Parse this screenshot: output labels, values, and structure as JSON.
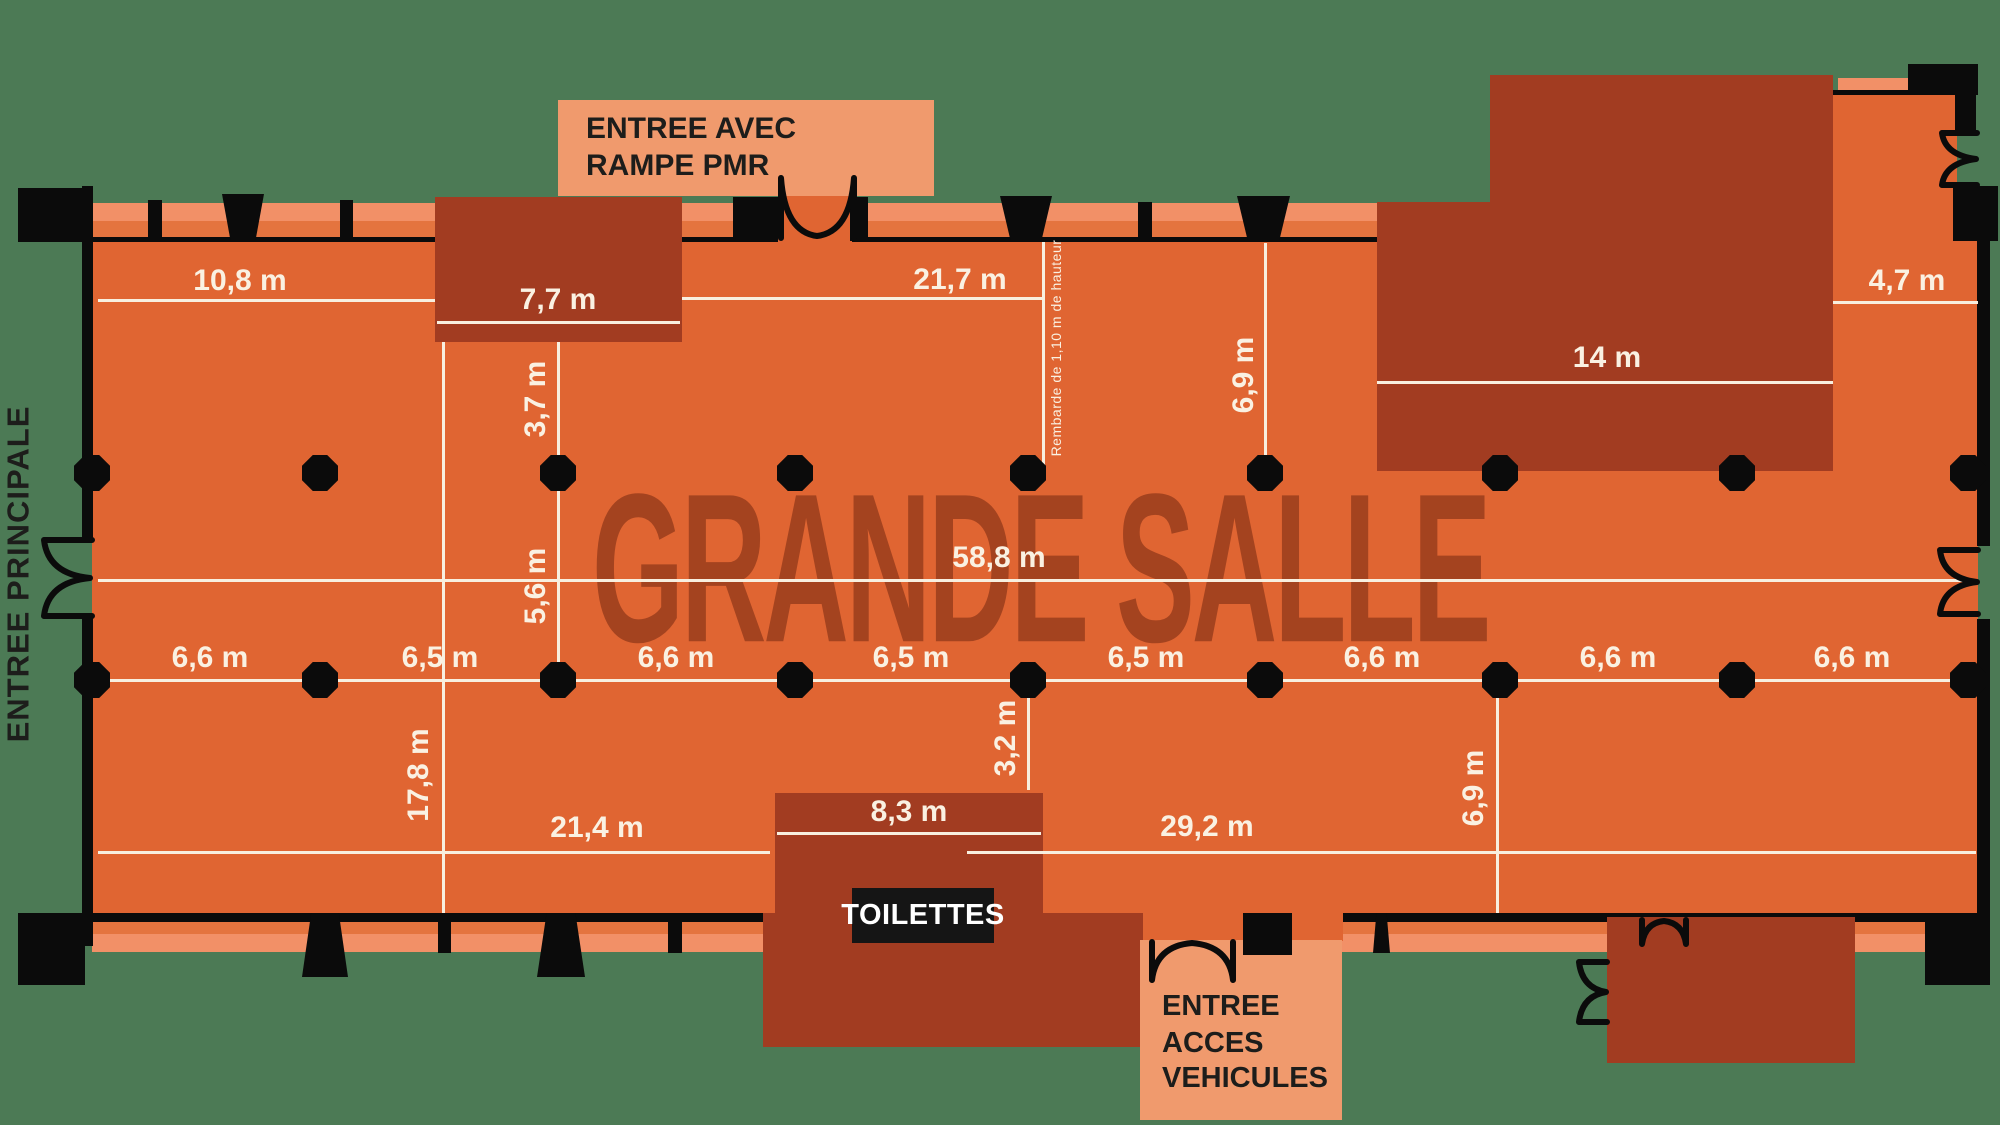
{
  "title": "GRANDE SALLE",
  "labels": {
    "entree_principale": "ENTREE PRINCIPALE",
    "entree_pmr_line1": "ENTREE AVEC",
    "entree_pmr_line2": "RAMPE PMR",
    "entree_vehicules_line1": "ENTREE",
    "entree_vehicules_line2": "ACCES",
    "entree_vehicules_line3": "VEHICULES",
    "toilettes": "TOILETTES",
    "railing_note": "Rembarde de 1,10 m de hauteur"
  },
  "dimensions": {
    "top_left_width": "10,8 m",
    "top_mid_width": "21,7 m",
    "annex_top_left_width": "7,7 m",
    "annex_top_right_width": "14 m",
    "top_right_width": "4,7 m",
    "hall_length": "58,8 m",
    "left_section_height": "17,8 m",
    "depth_upper": "3,7 m",
    "depth_lower": "5,6 m",
    "mezzanine_depth": "6,9 m",
    "pillar_offset": "3,2 m",
    "bottom_left_width": "21,4 m",
    "bottom_right_width": "29,2 m",
    "toilets_width": "8,3 m",
    "right_bay_depth": "6,9 m",
    "bays": [
      "6,6 m",
      "6,5 m",
      "6,6 m",
      "6,5 m",
      "6,5 m",
      "6,6 m",
      "6,6 m",
      "6,6 m"
    ]
  },
  "colors": {
    "background": "#4C7A55",
    "floor": "#E06532",
    "sill_light": "#F29067",
    "sill_mid": "#E4743F",
    "annex": "#A23C21",
    "vestibule": "#F09A6D",
    "wall": "#0B0B0B",
    "dimension_text": "#FAF1E2",
    "title_text": "#A4431F",
    "entrance_text": "#1D1D1B"
  }
}
